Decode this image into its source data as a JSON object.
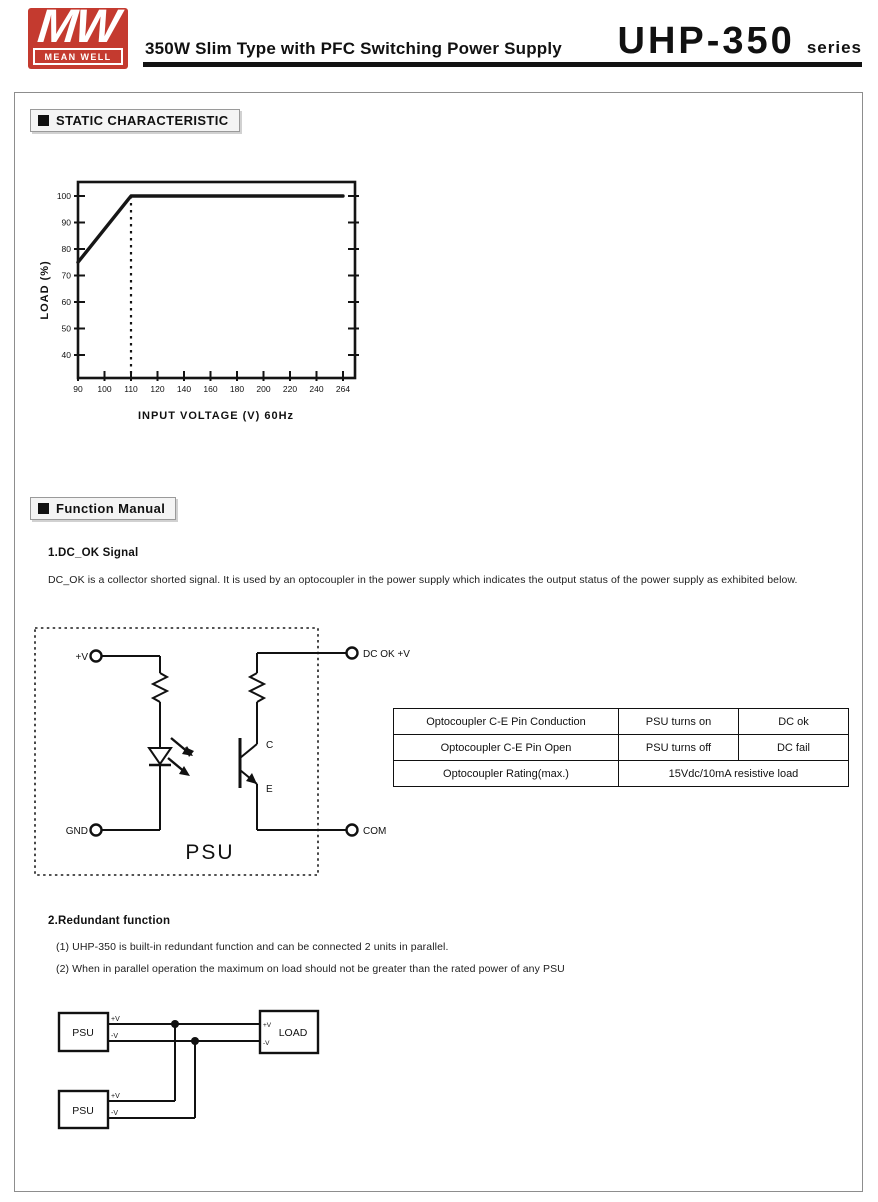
{
  "header": {
    "logo_mw": "MW",
    "logo_brand": "MEAN WELL",
    "subtitle": "350W Slim Type with PFC Switching Power Supply",
    "model": "UHP-350",
    "series": "series"
  },
  "sections": {
    "static_title": "STATIC CHARACTERISTIC",
    "function_manual_title": "Function Manual"
  },
  "chart_data": {
    "type": "line",
    "title": "",
    "xlabel": "INPUT VOLTAGE (V) 60Hz",
    "ylabel": "LOAD (%)",
    "x_ticks": [
      90,
      100,
      110,
      120,
      140,
      160,
      180,
      200,
      220,
      240,
      264
    ],
    "y_ticks": [
      100,
      90,
      80,
      70,
      60,
      50,
      40
    ],
    "ylim": [
      40,
      100
    ],
    "grid": "off",
    "series": [
      {
        "name": "load-vs-input-voltage",
        "points": [
          [
            90,
            75
          ],
          [
            110,
            100
          ],
          [
            264,
            100
          ]
        ]
      }
    ],
    "dashed_vline_x": 110,
    "line_color": "#161616"
  },
  "dc_ok": {
    "heading": "1.DC_OK Signal",
    "body": "DC_OK is a collector shorted signal. It is used by an optocoupler in the power supply which indicates the output status of the power supply as exhibited below.",
    "diagram": {
      "psu": "PSU",
      "plus_v": "+V",
      "gnd": "GND",
      "dc_ok_v": "DC OK +V",
      "com": "COM",
      "collector": "C",
      "emitter": "E"
    },
    "table": {
      "rows": [
        [
          "Optocoupler C-E Pin Conduction",
          "PSU turns on",
          "DC ok"
        ],
        [
          "Optocoupler C-E Pin Open",
          "PSU turns off",
          "DC fail"
        ],
        [
          "Optocoupler Rating(max.)",
          "15Vdc/10mA resistive load"
        ]
      ]
    }
  },
  "redundant": {
    "heading": "2.Redundant function",
    "notes": [
      "(1) UHP-350 is built-in redundant function and can be connected 2 units in parallel.",
      "(2) When in parallel operation the maximum on load should not be greater than the rated power of any PSU"
    ],
    "diagram": {
      "psu1": "PSU",
      "psu2": "PSU",
      "load": "LOAD",
      "plus_v": "+V",
      "minus_v": "-V"
    }
  },
  "colors": {
    "brand_red": "#c43a2f",
    "ink": "#111111"
  }
}
